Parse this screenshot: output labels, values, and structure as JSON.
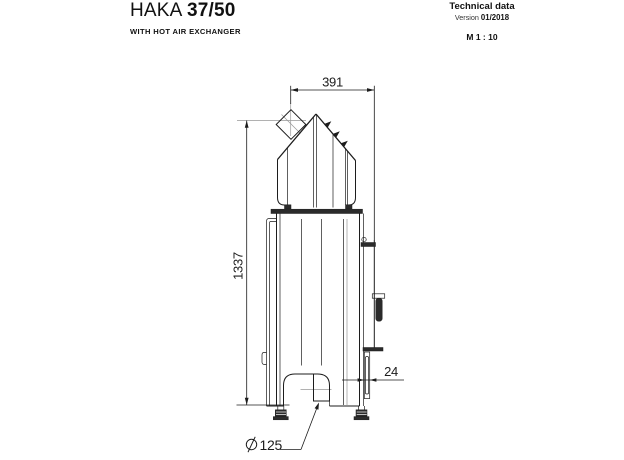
{
  "header": {
    "model": "HAKA",
    "variant": "37/50",
    "subtitle": "WITH HOT AIR EXCHANGER",
    "doc_type": "Technical data",
    "version_label": "Version",
    "version_value": "01/2018",
    "scale": "M 1 : 10"
  },
  "drawing": {
    "dimensions": {
      "flue_to_front_width": "391",
      "flue_axis_height": "1337",
      "door_protrusion": "24",
      "intake_symbol": "⌀",
      "intake_value": "125"
    },
    "colors": {
      "line": "#1c1c1c",
      "centerline": "#979797",
      "dark_fill": "#2b2b2b",
      "background": "#ffffff"
    }
  }
}
